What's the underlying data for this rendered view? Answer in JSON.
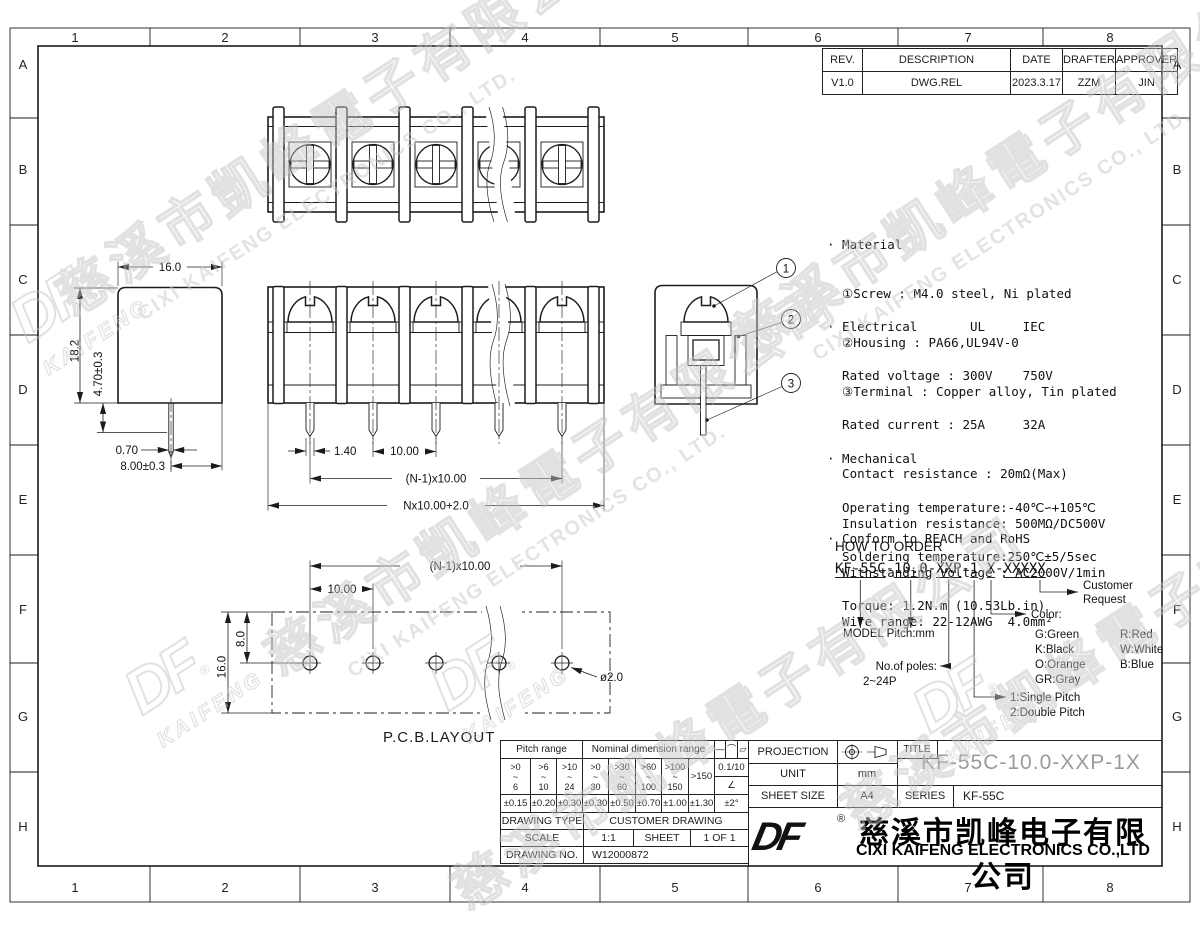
{
  "grid": {
    "cols": [
      "1",
      "2",
      "3",
      "4",
      "5",
      "6",
      "7",
      "8"
    ],
    "rows": [
      "A",
      "B",
      "C",
      "D",
      "E",
      "F",
      "G",
      "H"
    ]
  },
  "revision": {
    "headers": [
      "REV.",
      "DESCRIPTION",
      "DATE",
      "DRAFTER",
      "APPROVER"
    ],
    "row": [
      "V1.0",
      "DWG.REL",
      "2023.3.17",
      "ZZM",
      "JIN"
    ]
  },
  "notes": {
    "material": [
      "· Material",
      "  ①Screw : M4.0 steel, Ni plated",
      "  ②Housing : PA66,UL94V-0",
      "  ③Terminal : Copper alloy, Tin plated"
    ],
    "electrical": [
      "· Electrical       UL     IEC",
      "  Rated voltage : 300V    750V",
      "  Rated current : 25A     32A",
      "  Contact resistance : 20mΩ(Max)",
      "  Insulation resistance: 500MΩ/DC500V",
      "  Withstanding Voltage : AC2000V/1min",
      "  Wire range: 22-12AWG  4.0mm²"
    ],
    "mechanical": [
      "· Mechanical",
      "  Operating temperature:-40℃∽+105℃",
      "  Soldering temperature:250℃±5/5sec",
      "  Torque: 1.2N.m (10.53Lb.in)"
    ],
    "conform": "· Conform to REACH and RoHS"
  },
  "order": {
    "title": "HOW TO ORDER",
    "code": "KF-55C-10.0-XXP-1 X-XXXXX",
    "customer_1": "Customer",
    "customer_2": "Request",
    "color_title": "Color:",
    "colors": [
      [
        "G:Green",
        "R:Red"
      ],
      [
        "K:Black",
        "W:White"
      ],
      [
        "O:Orange",
        "B:Blue"
      ],
      [
        "GR:Gray",
        ""
      ]
    ],
    "model_label": "MODEL Pitch:mm",
    "poles_1": "No.of poles:",
    "poles_2": "2~24P",
    "pitch_1": "1:Single Pitch",
    "pitch_2": "2:Double Pitch"
  },
  "dims": {
    "side": {
      "w": "16.0",
      "h": "18.2",
      "pin_len": "4.70±0.3",
      "pin_w": "0.70",
      "pin_off": "8.00±0.3"
    },
    "front": {
      "pin_w": "1.40",
      "pitch": "10.00",
      "span": "(N-1)x10.00",
      "total": "Nx10.00+2.0"
    },
    "pcb": {
      "span": "(N-1)x10.00",
      "pitch": "10.00",
      "v8": "8.0",
      "v16": "16.0",
      "hole": "ø2.0",
      "label": "P.C.B.LAYOUT"
    }
  },
  "balloons": [
    "1",
    "2",
    "3"
  ],
  "tol": {
    "pitch_header": "Pitch range",
    "nominal_header": "Nominal dimension range",
    "symbols": [
      "—",
      "⌒",
      "▱"
    ],
    "ranges": [
      [
        ">0",
        "~",
        "6"
      ],
      [
        ">6",
        "~",
        "10"
      ],
      [
        ">10",
        "~",
        "24"
      ],
      [
        ">0",
        "~",
        "30"
      ],
      [
        ">30",
        "~",
        "60"
      ],
      [
        ">60",
        "~",
        "100"
      ],
      [
        ">100",
        "~",
        "150"
      ]
    ],
    "range_last": ">150",
    "ratio": "0.1/10",
    "angle_symbol": "∠",
    "tols": [
      "±0.15",
      "±0.20",
      "±0.30",
      "±0.30",
      "±0.50",
      "±0.70",
      "±1.00",
      "±1.30"
    ],
    "angle_tol": "±2°"
  },
  "drawing_info": {
    "type_label": "DRAWING TYPE",
    "type_value": "CUSTOMER DRAWING",
    "scale_label": "SCALE",
    "scale_value": "1:1",
    "sheet_label": "SHEET",
    "sheet_value": "1 OF 1",
    "no_label": "DRAWING NO.",
    "no_value": "W12000872"
  },
  "title_block": {
    "projection_label": "PROJECTION",
    "unit_label": "UNIT",
    "unit_value": "mm",
    "sheet_size_label": "SHEET SIZE",
    "sheet_size_value": "A4",
    "title_label": "TITLE",
    "title_value": "KF-55C-10.0-XXP-1X",
    "series_label": "SERIES",
    "series_value": "KF-55C"
  },
  "company": {
    "logo": "DF",
    "reg": "®",
    "cn": "慈溪市凯峰电子有限公司",
    "en": "CIXI KAIFENG ELECTRONICS CO.,LTD"
  },
  "watermark": {
    "cn": "慈溪市凱峰電子有限公司",
    "en": "CIXI KAIFENG ELECTRONICS CO., LTD.",
    "logo": "DF",
    "logo_sub": "KAIFENG",
    "reg": "®"
  }
}
